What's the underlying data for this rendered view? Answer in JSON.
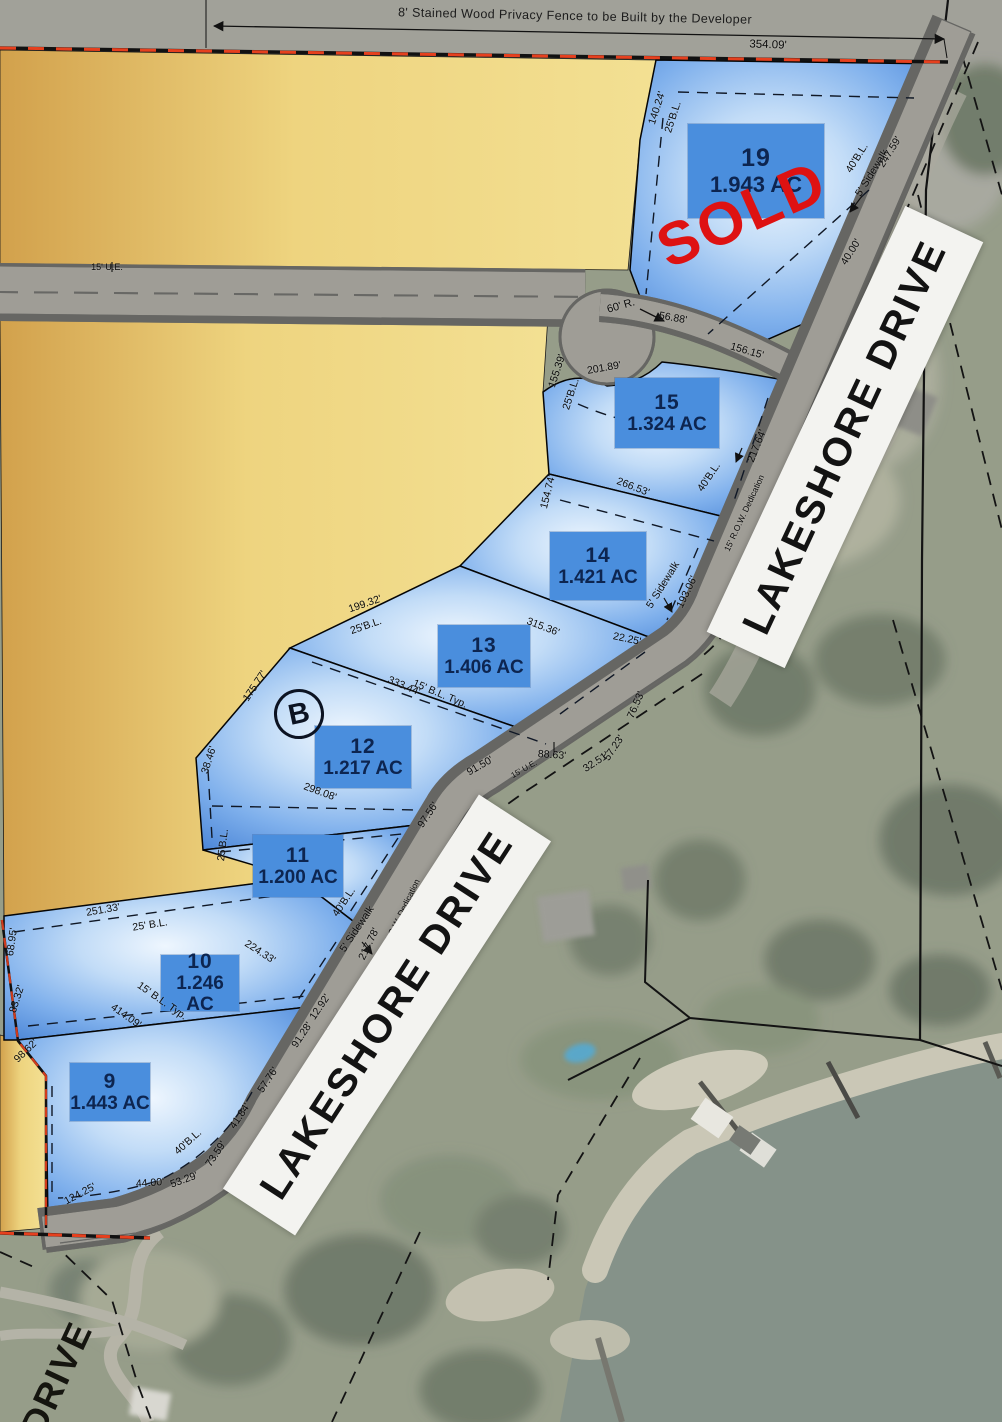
{
  "map": {
    "fence_note": "8' Stained Wood Privacy Fence to be Built by the Developer",
    "sold_label": "SOLD",
    "block_label": "B",
    "street_label_bottom": "DRIVE",
    "street_banners": [
      {
        "label": "LAKESHORE DRIVE"
      },
      {
        "label": "LAKESHORE DRIVE"
      }
    ],
    "lots": [
      {
        "number": "19",
        "acreage": "1.943 AC",
        "status": "SOLD",
        "x": 756,
        "y": 171,
        "w": 136,
        "h": 94,
        "large": true
      },
      {
        "number": "15",
        "acreage": "1.324 AC",
        "x": 667,
        "y": 413,
        "w": 104,
        "h": 70
      },
      {
        "number": "14",
        "acreage": "1.421 AC",
        "x": 598,
        "y": 566,
        "w": 96,
        "h": 68
      },
      {
        "number": "13",
        "acreage": "1.406 AC",
        "x": 484,
        "y": 656,
        "w": 92,
        "h": 62
      },
      {
        "number": "12",
        "acreage": "1.217 AC",
        "x": 363,
        "y": 757,
        "w": 96,
        "h": 62
      },
      {
        "number": "11",
        "acreage": "1.200 AC",
        "x": 298,
        "y": 866,
        "w": 90,
        "h": 62
      },
      {
        "number": "10",
        "acreage": "1.246 AC",
        "x": 200,
        "y": 983,
        "w": 78,
        "h": 56
      },
      {
        "number": "9",
        "acreage": "1.443 AC",
        "x": 110,
        "y": 1092,
        "w": 80,
        "h": 58
      }
    ],
    "dim_labels": [
      {
        "t": "354.09'",
        "x": 768,
        "y": 45,
        "r": 2,
        "s": 11.5
      },
      {
        "t": "140.24'",
        "x": 657,
        "y": 108,
        "r": -72
      },
      {
        "t": "25'B.L.",
        "x": 673,
        "y": 117,
        "r": -72
      },
      {
        "t": "40'B.L.",
        "x": 857,
        "y": 158,
        "r": -58
      },
      {
        "t": "5' Sidewalk",
        "x": 872,
        "y": 173,
        "r": -58
      },
      {
        "t": "247.59'",
        "x": 890,
        "y": 152,
        "r": -58
      },
      {
        "t": "40.00'",
        "x": 851,
        "y": 252,
        "r": -58
      },
      {
        "t": "60' R.",
        "x": 621,
        "y": 306,
        "r": -16,
        "s": 11
      },
      {
        "t": "56.88'",
        "x": 673,
        "y": 318,
        "r": 10
      },
      {
        "t": "156.15'",
        "x": 747,
        "y": 351,
        "r": 16
      },
      {
        "t": "201.89'",
        "x": 604,
        "y": 368,
        "r": -10
      },
      {
        "t": "155.39'",
        "x": 557,
        "y": 371,
        "r": -72
      },
      {
        "t": "25'B.L.",
        "x": 571,
        "y": 394,
        "r": -72
      },
      {
        "t": "217.64'",
        "x": 757,
        "y": 446,
        "r": -68
      },
      {
        "t": "40'B.L.",
        "x": 709,
        "y": 477,
        "r": -56
      },
      {
        "t": "266.53'",
        "x": 633,
        "y": 487,
        "r": 21
      },
      {
        "t": "154.74'",
        "x": 548,
        "y": 492,
        "r": -76
      },
      {
        "t": "5' Sidewalk",
        "x": 663,
        "y": 585,
        "r": -58
      },
      {
        "t": "193.06'",
        "x": 687,
        "y": 592,
        "r": -64
      },
      {
        "t": "15' R.O.W. Dedication",
        "x": 744,
        "y": 513,
        "r": -65,
        "s": 8.5
      },
      {
        "t": "315.36'",
        "x": 543,
        "y": 627,
        "r": 21
      },
      {
        "t": "22.25'",
        "x": 627,
        "y": 639,
        "r": 12
      },
      {
        "t": "199.32'",
        "x": 365,
        "y": 604,
        "r": -19
      },
      {
        "t": "25'B.L.",
        "x": 366,
        "y": 626,
        "r": -19
      },
      {
        "t": "333.44'",
        "x": 404,
        "y": 686,
        "r": 23
      },
      {
        "t": "15' B.L. Typ.",
        "x": 440,
        "y": 694,
        "r": 23
      },
      {
        "t": "76.53'",
        "x": 636,
        "y": 705,
        "r": -66
      },
      {
        "t": "88.63'",
        "x": 552,
        "y": 755,
        "r": 4
      },
      {
        "t": "32.51'",
        "x": 596,
        "y": 762,
        "r": -33
      },
      {
        "t": "57.23'",
        "x": 614,
        "y": 748,
        "r": -56
      },
      {
        "t": "91.50'",
        "x": 480,
        "y": 766,
        "r": -30
      },
      {
        "t": "15' U.E.",
        "x": 524,
        "y": 769,
        "r": -30,
        "s": 8
      },
      {
        "t": "175.77'",
        "x": 255,
        "y": 686,
        "r": -56
      },
      {
        "t": "38.46'",
        "x": 209,
        "y": 760,
        "r": -72
      },
      {
        "t": "298.08'",
        "x": 320,
        "y": 792,
        "r": 20
      },
      {
        "t": "97.56'",
        "x": 428,
        "y": 815,
        "r": -56
      },
      {
        "t": "25'B.L.",
        "x": 223,
        "y": 845,
        "r": -83
      },
      {
        "t": "40'B.L.",
        "x": 344,
        "y": 902,
        "r": -56
      },
      {
        "t": "5' Sidewalk",
        "x": 357,
        "y": 929,
        "r": -56
      },
      {
        "t": "217.78'",
        "x": 369,
        "y": 944,
        "r": -64
      },
      {
        "t": "15' R.O.W. Dedication",
        "x": 399,
        "y": 917,
        "r": -64,
        "s": 8.5
      },
      {
        "t": "251.33'",
        "x": 103,
        "y": 910,
        "r": -10
      },
      {
        "t": "25' B.L.",
        "x": 150,
        "y": 925,
        "r": -9
      },
      {
        "t": "224.33'",
        "x": 260,
        "y": 952,
        "r": 33
      },
      {
        "t": "15' B.L. Typ.",
        "x": 162,
        "y": 1001,
        "r": 35
      },
      {
        "t": "414.09'",
        "x": 126,
        "y": 1016,
        "r": 35
      },
      {
        "t": "68.95'",
        "x": 12,
        "y": 942,
        "r": -82
      },
      {
        "t": "83.32'",
        "x": 17,
        "y": 999,
        "r": -72
      },
      {
        "t": "98.62'",
        "x": 26,
        "y": 1051,
        "r": -44
      },
      {
        "t": "12.92'",
        "x": 320,
        "y": 1007,
        "r": -56
      },
      {
        "t": "91.28'",
        "x": 302,
        "y": 1035,
        "r": -56
      },
      {
        "t": "57.76'",
        "x": 268,
        "y": 1080,
        "r": -56
      },
      {
        "t": "41.84'",
        "x": 240,
        "y": 1116,
        "r": -56
      },
      {
        "t": "40'B.L.",
        "x": 188,
        "y": 1142,
        "r": -42
      },
      {
        "t": "73.59'",
        "x": 216,
        "y": 1154,
        "r": -56
      },
      {
        "t": "53.29'",
        "x": 184,
        "y": 1180,
        "r": -20
      },
      {
        "t": "44.00'",
        "x": 150,
        "y": 1183,
        "r": -4
      },
      {
        "t": "124.25'",
        "x": 80,
        "y": 1194,
        "r": -28
      },
      {
        "t": "15' U.E.",
        "x": 107,
        "y": 267,
        "r": 0,
        "s": 9
      }
    ],
    "colors": {
      "lot_fill_edge": "#3a78d0",
      "lot_label_box": "#4a8edd",
      "parcel_yellow": "#eed47f",
      "road_gray": "#a7a49b",
      "boundary_red": "#e6401e",
      "sold_red": "#de1212",
      "water": "#75867d",
      "banner_white": "#f3f3f0"
    }
  }
}
